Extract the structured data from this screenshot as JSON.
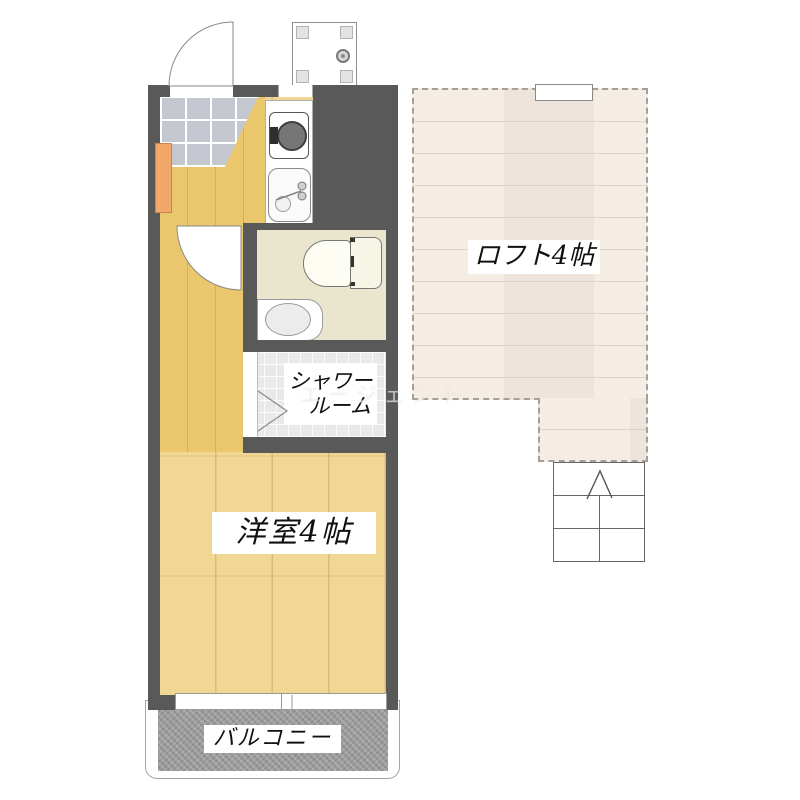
{
  "labels": {
    "loft": "ロフト4帖",
    "main_room": "洋室4帖",
    "shower_line1": "シャワー",
    "shower_line2": "ルーム",
    "balcony": "バルコニー",
    "watermark": "エージェント"
  },
  "colors": {
    "wall": "#595959",
    "main_floor": "#f0d794",
    "hall_floor": "#eac76c",
    "loft_floor": "#f5ece4",
    "toilet_floor": "#eae6ce",
    "shower_floor": "#e9eae7",
    "balcony_floor": "#9b9b9b",
    "entry_tile": "#c4c7d0",
    "cabinet": "#f2a86b"
  }
}
